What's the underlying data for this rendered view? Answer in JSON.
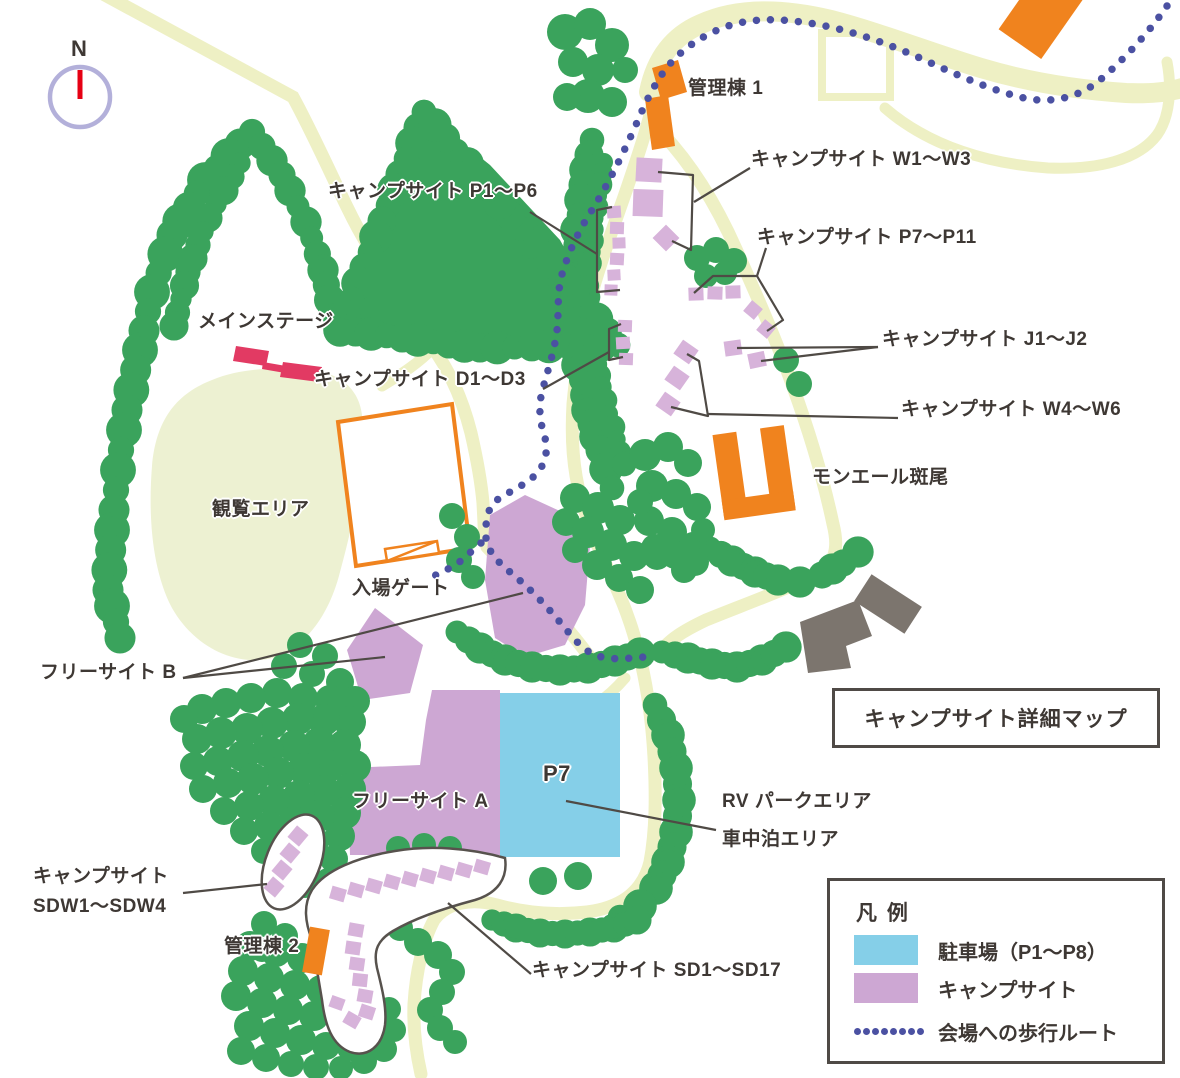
{
  "map": {
    "compass": {
      "n": "N"
    },
    "title_box": "キャンプサイト詳細マップ",
    "labels": {
      "kanritou1": "管理棟 1",
      "w1w3": "キャンプサイト W1～W3",
      "p1p6": "キャンプサイト P1～P6",
      "p7p11": "キャンプサイト P7～P11",
      "j1j2": "キャンプサイト J1～J2",
      "w4w6": "キャンプサイト W4～W6",
      "d1d3": "キャンプサイト D1～D3",
      "mainstage": "メインステージ",
      "kanran": "観覧エリア",
      "nyujo": "入場ゲート",
      "free_b": "フリーサイト B",
      "free_a": "フリーサイト A",
      "mon": "モンエール斑尾",
      "p7": "P7",
      "rv1": "RV パークエリア",
      "rv2": "車中泊エリア",
      "sdw1": "キャンプサイト",
      "sdw2": "SDW1～SDW4",
      "kanritou2": "管理棟 2",
      "sd": "キャンプサイト SD1～SD17"
    },
    "legend": {
      "title": "凡 例",
      "items": [
        {
          "key": "parking",
          "label": "駐車場（P1～P8）",
          "swatch": "#85cfe8"
        },
        {
          "key": "campsite",
          "label": "キャンプサイト",
          "swatch": "#cda7d3"
        },
        {
          "key": "route",
          "label": "会場への歩行ルート",
          "swatch": "#4b51a2"
        }
      ]
    },
    "colors": {
      "tree": "#3aa35c",
      "road": "#eef0c4",
      "view_area": "#edf1d2",
      "campsite_area": "#cda7d3",
      "site_marker": "#d7b3da",
      "parking": "#85cfe8",
      "building": "#f0831e",
      "stage": "#e23a63",
      "gray_building": "#7c756e",
      "route": "#4b51a2",
      "leader": "#4f4a45",
      "ink": "#3e3834",
      "compass_ring": "#b3b0da",
      "compass_needle": "#e60014"
    }
  }
}
